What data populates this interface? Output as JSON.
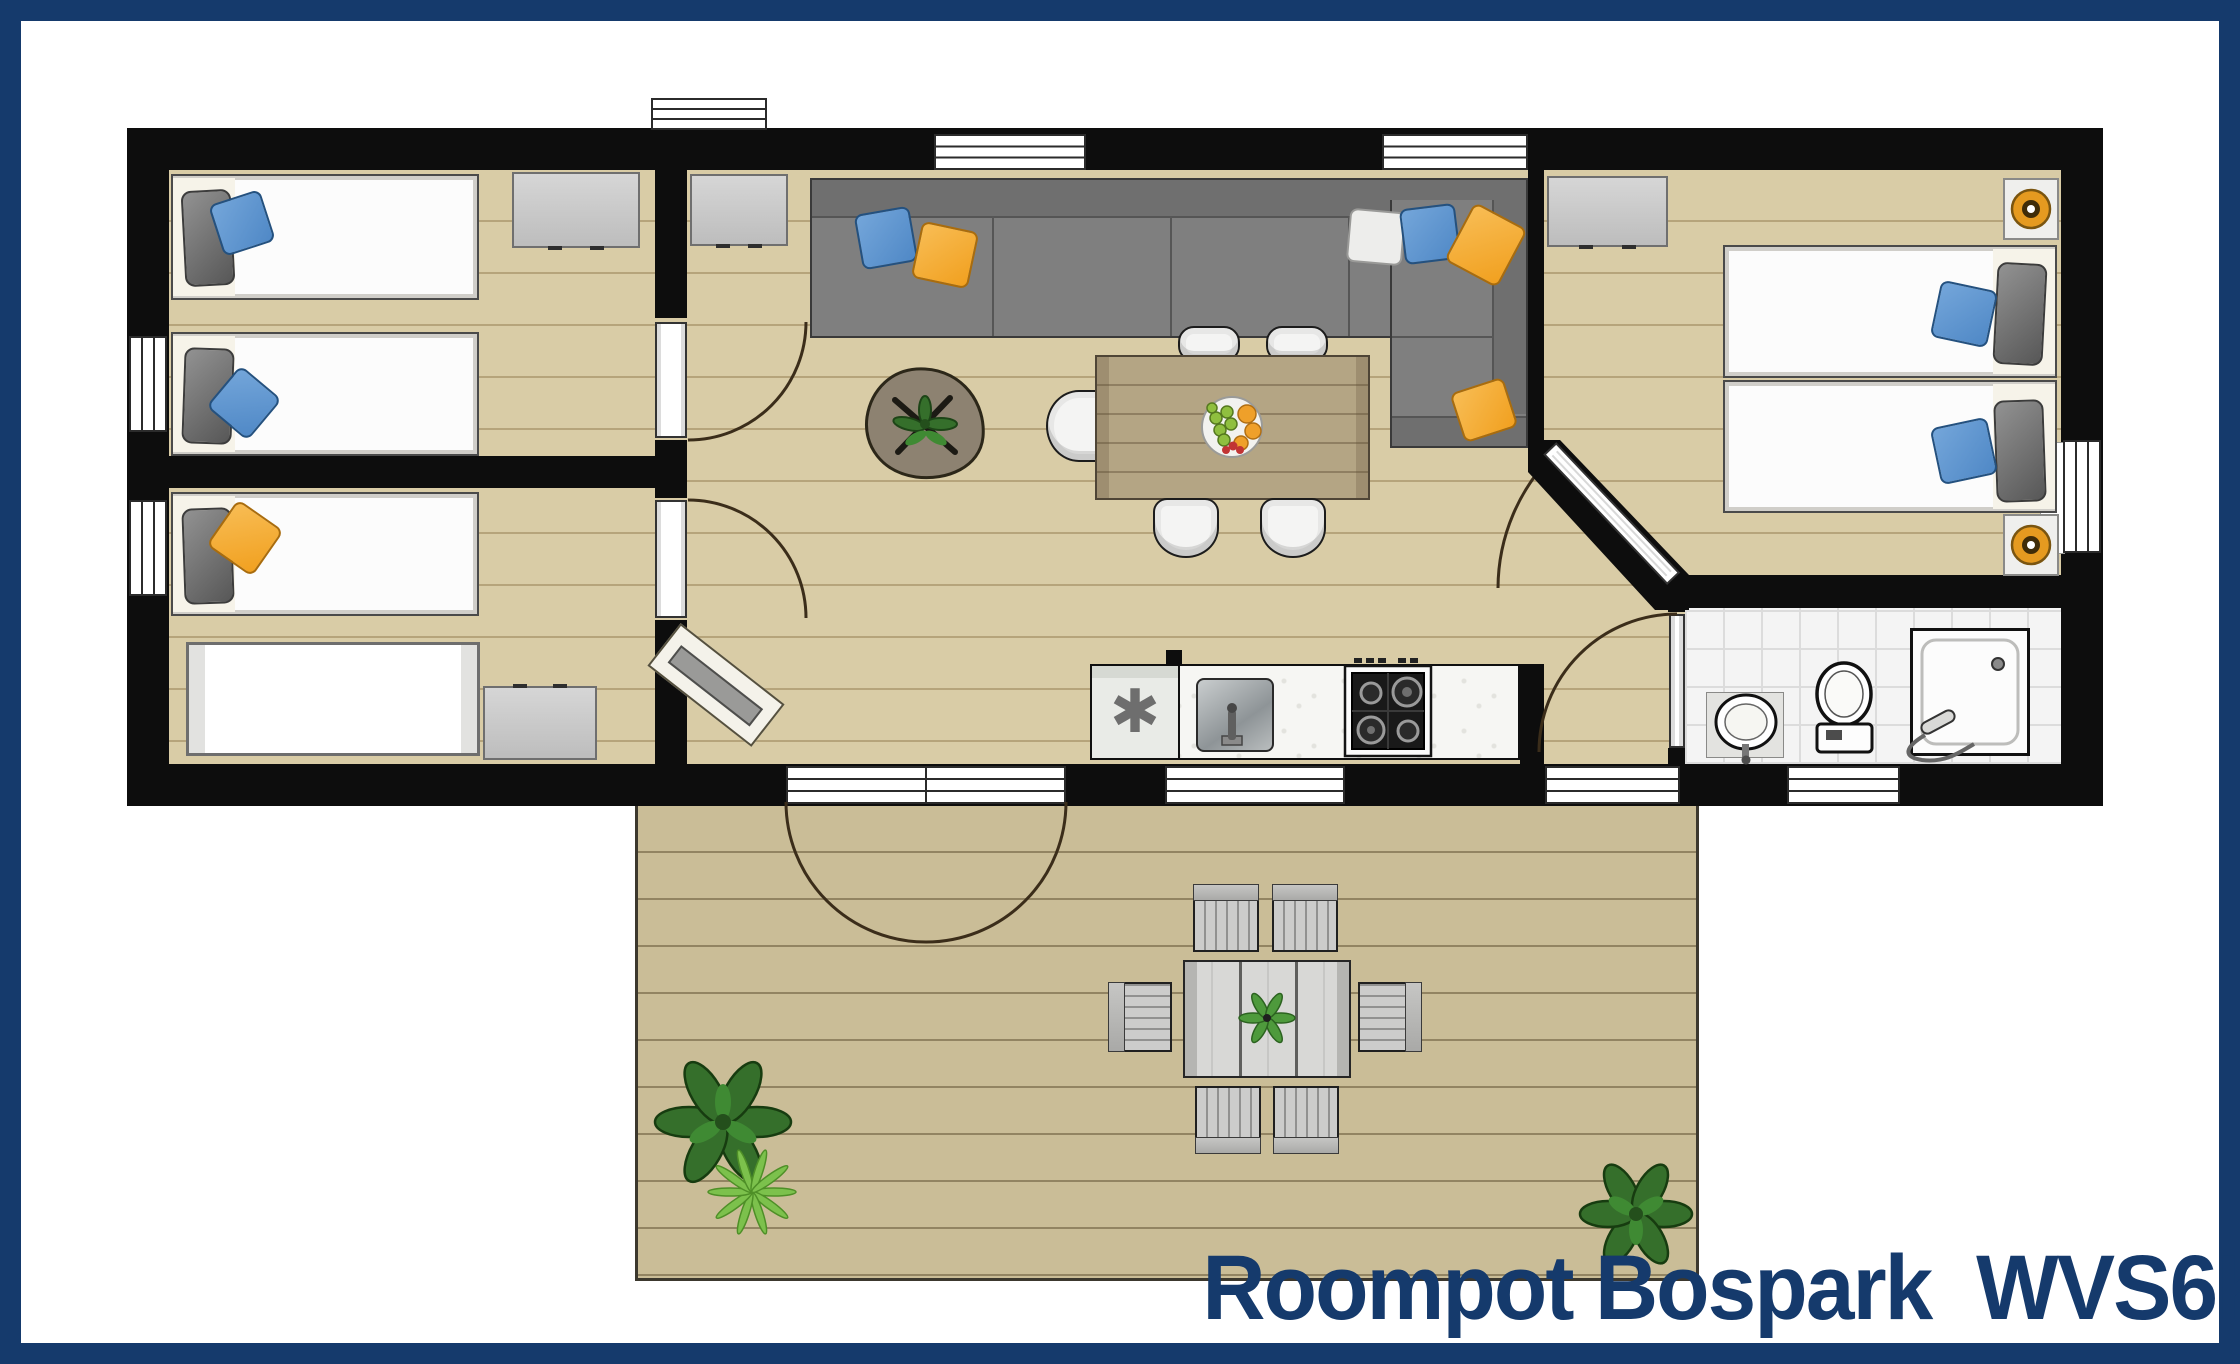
{
  "title": {
    "text": "Roompot Bospark  WVS6K"
  },
  "icons": {
    "freezer_symbol": "✱"
  },
  "colors": {
    "frame_navy": "#153a6c",
    "wall_black": "#0d0d0d",
    "floor_wood": "#d9cca6",
    "terrace_wood": "#cabd97",
    "sofa_gray": "#7f7f7f",
    "sofa_dark": "#6f6f6f",
    "sofa_border": "#3a3a3a",
    "pillow_blue": "#4f88c6",
    "pillow_orange": "#f1a01f",
    "pillow_white": "#ececea",
    "mattress_white": "#fcfcfc",
    "headboard_cream": "#f6f3e9",
    "dresser_gray": "#c9c9c9",
    "table_wood": "#b4a584",
    "chair_white": "#f4f4f3",
    "counter_white": "#f6f6f3",
    "tile_white": "#f4f4f4",
    "tile_line": "#dcdcdc",
    "window_frame": "#2b2b2b",
    "door_arc": "#3b2d1a",
    "lamp_orange": "#e59a20",
    "plant_dark": "#356f2b",
    "plant_light": "#7cc14c",
    "fruit_green": "#8fbf3f",
    "fruit_orange": "#efa02a",
    "fruit_red": "#c13434"
  },
  "plan": {
    "rooms": [
      "bedroom-top-left",
      "bedroom-bottom-left",
      "living-room",
      "dining-area",
      "kitchen",
      "hallway",
      "bedroom-right",
      "bathroom",
      "terrace"
    ],
    "furniture": [
      {
        "name": "single-bed",
        "count": 5
      },
      {
        "name": "baby-cot",
        "count": 1
      },
      {
        "name": "chest-of-drawers",
        "count": 4
      },
      {
        "name": "corner-sofa",
        "count": 1
      },
      {
        "name": "sofa-cushion",
        "count": 7
      },
      {
        "name": "coffee-table-with-plant",
        "count": 1
      },
      {
        "name": "dining-table",
        "count": 1
      },
      {
        "name": "dining-chair",
        "count": 5
      },
      {
        "name": "fruit-bowl",
        "count": 1
      },
      {
        "name": "fridge-freezer",
        "count": 1
      },
      {
        "name": "kitchen-sink",
        "count": 1
      },
      {
        "name": "gas-hob",
        "count": 1
      },
      {
        "name": "washbasin",
        "count": 1
      },
      {
        "name": "toilet",
        "count": 1
      },
      {
        "name": "shower",
        "count": 1
      },
      {
        "name": "nightstand-with-lamp",
        "count": 2
      },
      {
        "name": "doormat",
        "count": 1
      },
      {
        "name": "outdoor-dining-table",
        "count": 1
      },
      {
        "name": "outdoor-chair",
        "count": 6
      },
      {
        "name": "potted-plant",
        "count": 3
      },
      {
        "name": "interior-door",
        "count": 4
      },
      {
        "name": "terrace-double-door",
        "count": 1
      },
      {
        "name": "window",
        "count": 9
      }
    ]
  }
}
